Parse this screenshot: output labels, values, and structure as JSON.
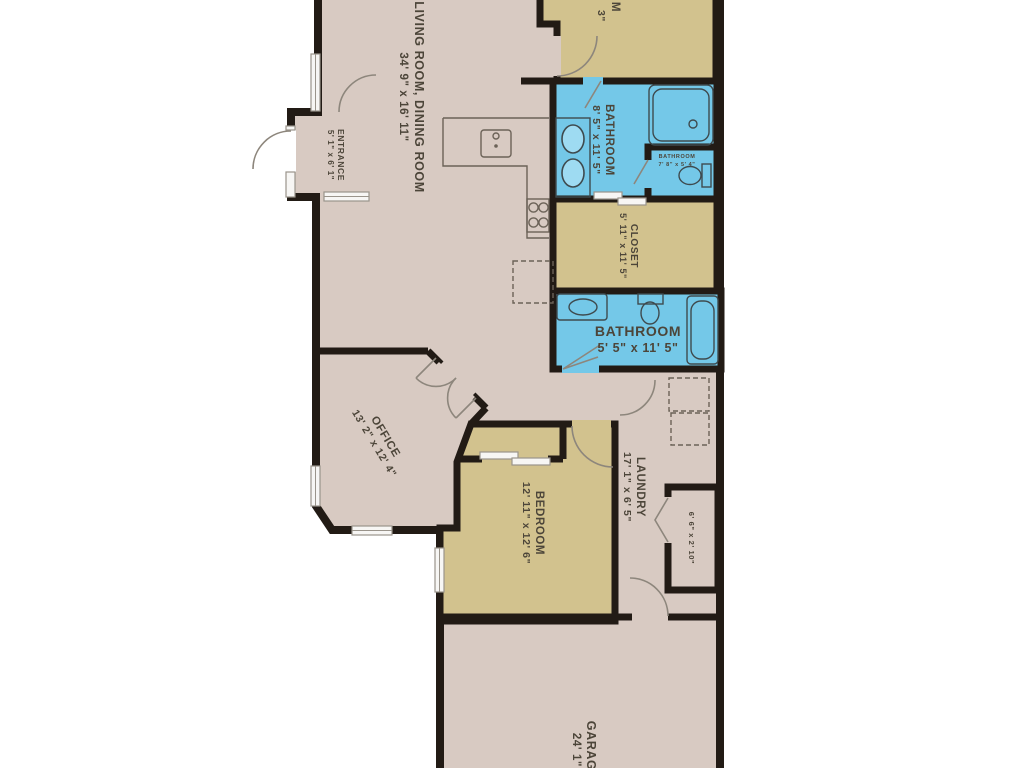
{
  "type": "floor-plan",
  "colors": {
    "wall": "#221b15",
    "floor_main": "#d8cac2",
    "floor_accent": "#d2c28e",
    "floor_bathroom": "#74c8e8",
    "label_text": "#4c4539",
    "background": "#ffffff"
  },
  "rooms": {
    "living_dining": {
      "label": "LIVING ROOM, DINING ROOM",
      "dims": "34' 9\" x 16' 11\""
    },
    "entrance": {
      "label": "ENTRANCE",
      "dims": "5' 1\" x 6' 1\""
    },
    "bedroom_top_partial": {
      "label": "M",
      "dims": "3\""
    },
    "bathroom_main": {
      "label": "BATHROOM",
      "dims": "8' 5\" x 11' 5\""
    },
    "bathroom_small": {
      "label": "BATHROOM",
      "dims": "7' 8\" x 5' 4\""
    },
    "closet": {
      "label": "CLOSET",
      "dims": "5' 11\" x 11' 5\""
    },
    "bathroom_hall": {
      "label": "BATHROOM",
      "dims": "5' 5\" x 11' 5\""
    },
    "office": {
      "label": "OFFICE",
      "dims": "13' 2\" x 12' 4\""
    },
    "bedroom": {
      "label": "BEDROOM",
      "dims": "12' 11\" x 12' 6\""
    },
    "laundry": {
      "label": "LAUNDRY",
      "dims": "17' 1\" x 6' 5\""
    },
    "laundry_closet": {
      "dims": "6' 6\" x 2' 10\""
    },
    "garage": {
      "label": "GARAGE",
      "dims": "24' 1\""
    }
  }
}
